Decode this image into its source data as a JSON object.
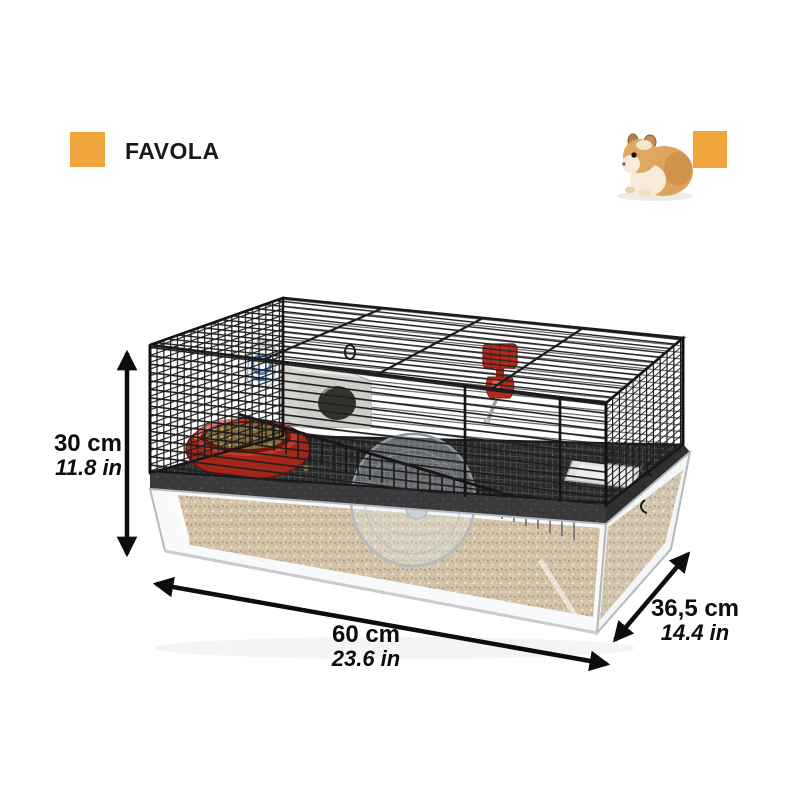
{
  "brand": {
    "name": "FAVOLA",
    "accent_color": "#F0A43C"
  },
  "dimensions": {
    "height": {
      "metric": "30 cm",
      "imperial": "11.8 in"
    },
    "length": {
      "metric": "60 cm",
      "imperial": "23.6 in"
    },
    "depth": {
      "metric": "36,5 cm",
      "imperial": "14.4 in"
    }
  },
  "product": {
    "kind": "hamster cage dimension illustration",
    "accessories": [
      "food-bowl",
      "hideout-house",
      "water-bottle-blue",
      "water-bottle-red",
      "exercise-wheel",
      "bedding",
      "sand-tray"
    ]
  },
  "colors": {
    "accent": "#F0A43C",
    "wire": "#1d1d1d",
    "bedding": "#c3aa7d",
    "bowl_red": "#a3261a",
    "bottle_red": "#b32b1e",
    "house_grey": "#d4d4d0",
    "label_text": "#0d0d0d"
  }
}
